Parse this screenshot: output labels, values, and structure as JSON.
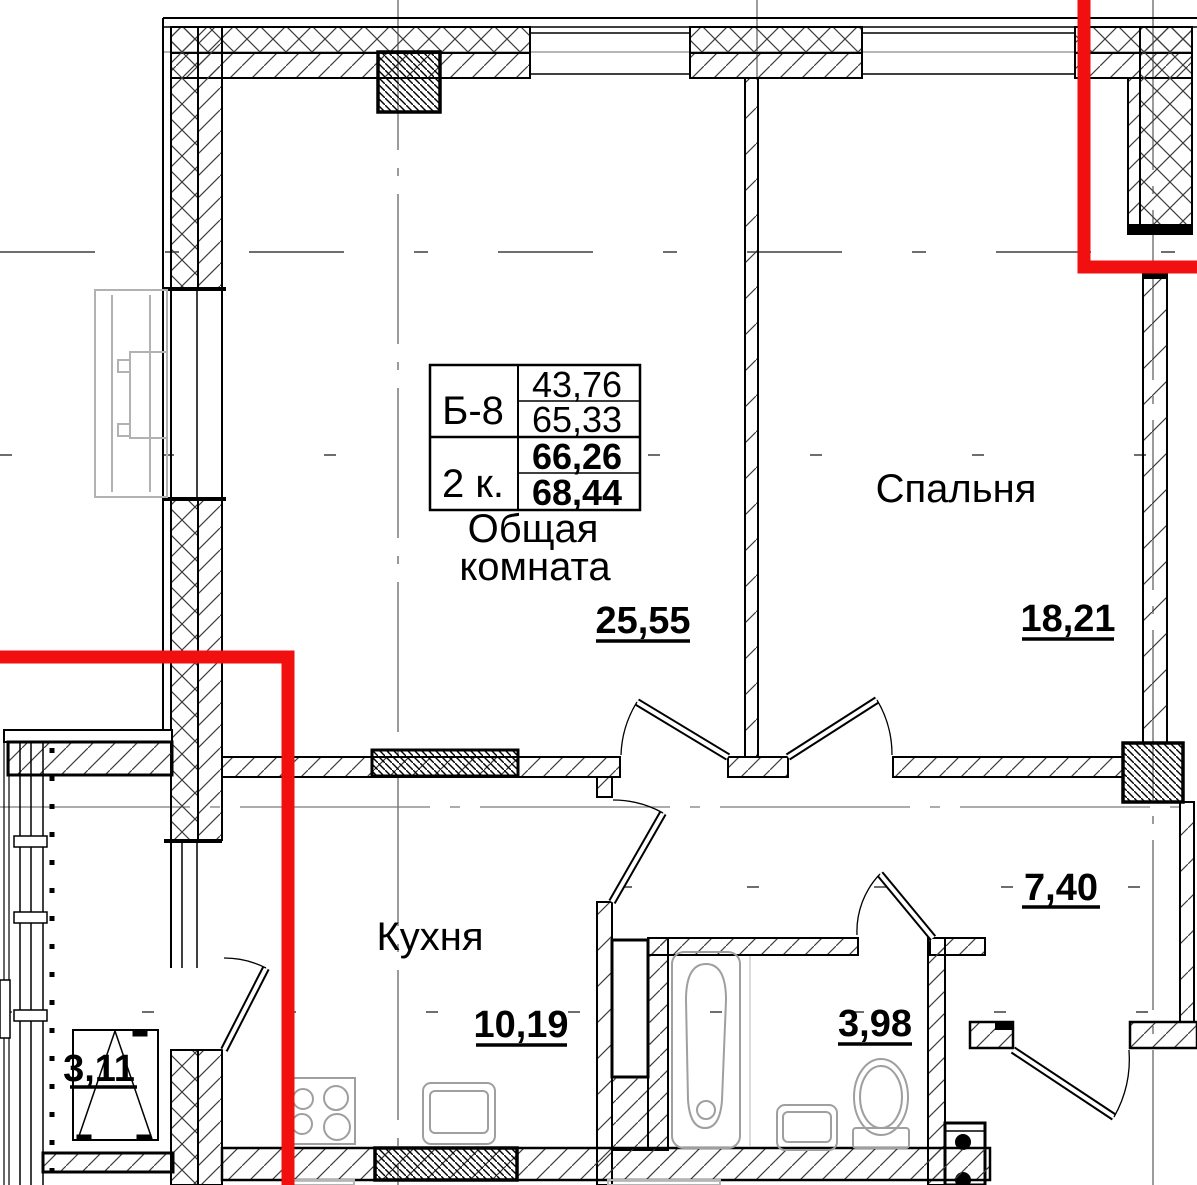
{
  "plan": {
    "info_table": {
      "unit_id": "Б-8",
      "unit_type": "2 к.",
      "area_values": [
        "43,76",
        "65,33",
        "66,26",
        "68,44"
      ]
    },
    "rooms": {
      "living": {
        "name_line1": "Общая",
        "name_line2": "комната",
        "area": "25,55"
      },
      "bedroom": {
        "name": "Спальня",
        "area": "18,21"
      },
      "kitchen": {
        "name": "Кухня",
        "area": "10,19"
      },
      "bathroom": {
        "area": "3,98"
      },
      "hallway": {
        "area": "7,40"
      },
      "balcony": {
        "area": "3,11"
      }
    },
    "colors": {
      "section_line": "#f20f0f",
      "wall_line": "#000000",
      "fixture_line": "#9f9f9f",
      "axis_line": "#7a7a7a",
      "neighbor_line": "#b2b2b2"
    }
  }
}
